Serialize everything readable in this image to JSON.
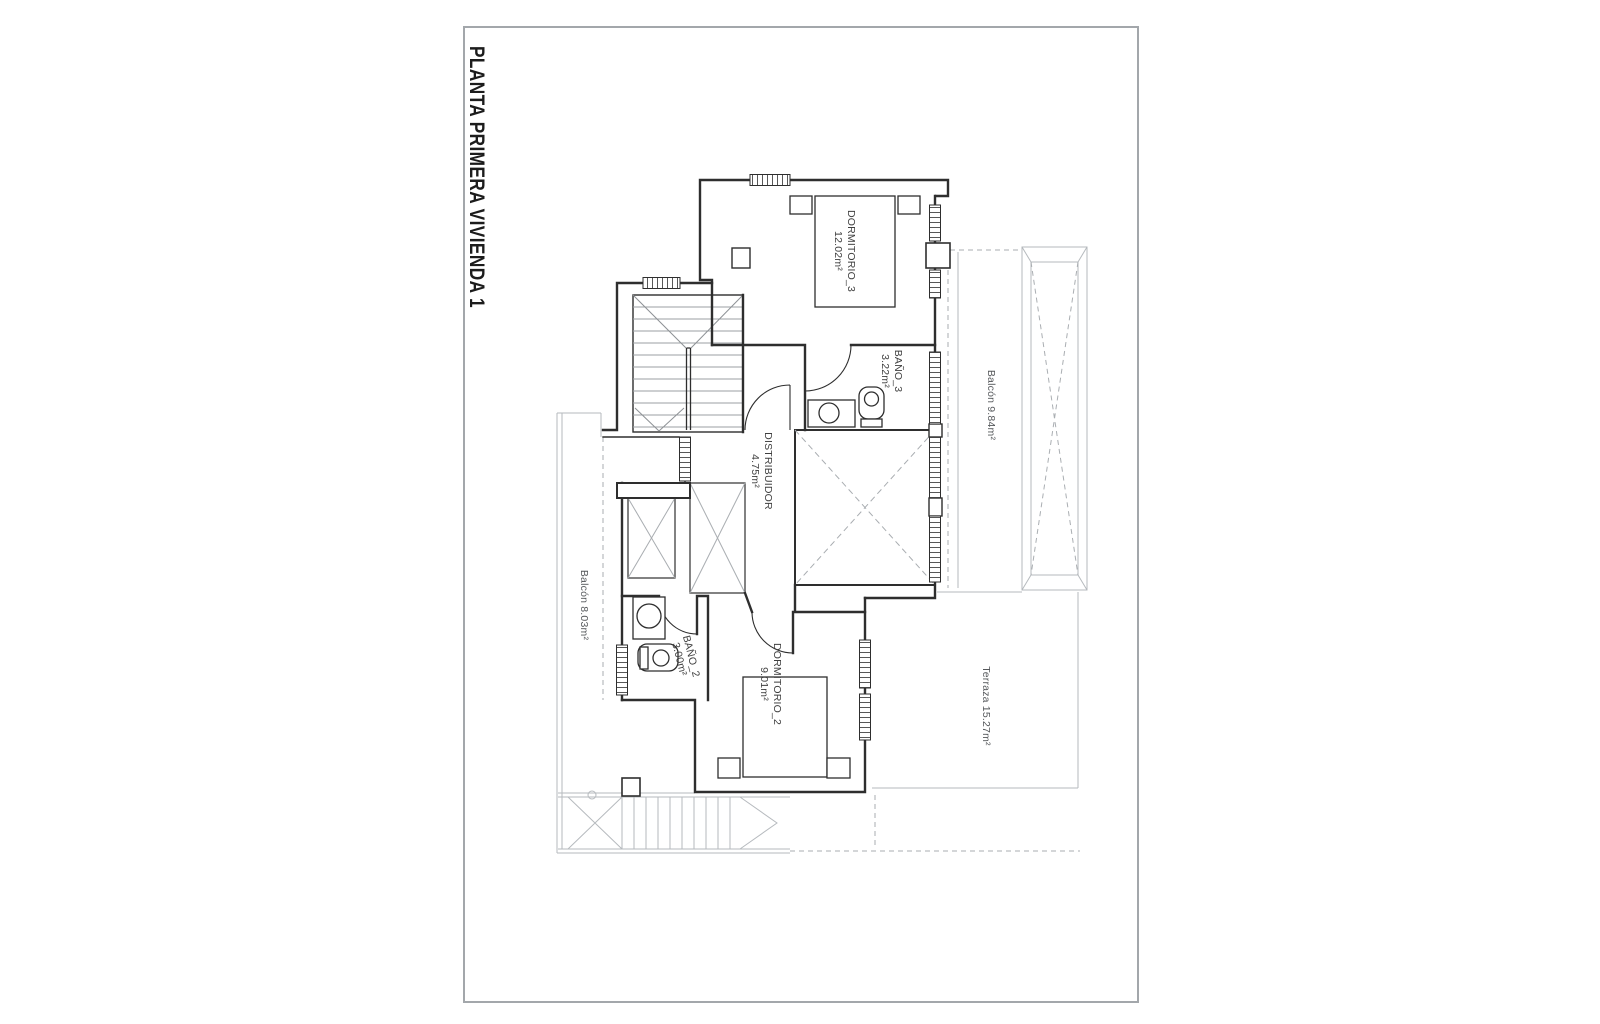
{
  "title": "PLANTA PRIMERA VIVIENDA 1",
  "rooms": [
    {
      "id": "dormitorio-3",
      "name": "DORMITORIO_3",
      "area": "12.02m²"
    },
    {
      "id": "bano-3",
      "name": "BAÑO_3",
      "area": "3.22m²"
    },
    {
      "id": "distribuidor",
      "name": "DISTRIBUIDOR",
      "area": "4.75m²"
    },
    {
      "id": "bano-2",
      "name": "BAÑO_2",
      "area": "3.00m²"
    },
    {
      "id": "dormitorio-2",
      "name": "DORMITORIO_2",
      "area": "9.01m²"
    }
  ],
  "outdoor": [
    {
      "id": "balcon-right",
      "label": "Balcón 9.84m²"
    },
    {
      "id": "balcon-left",
      "label": "Balcón 8.03m²"
    },
    {
      "id": "terraza",
      "label": "Terraza 15.27m²"
    }
  ],
  "colors": {
    "wall_line": "#2e2e2e",
    "light_line": "#b6babe",
    "frame_line": "#a3a7ab",
    "detail_gray": "#9b9fa3"
  }
}
